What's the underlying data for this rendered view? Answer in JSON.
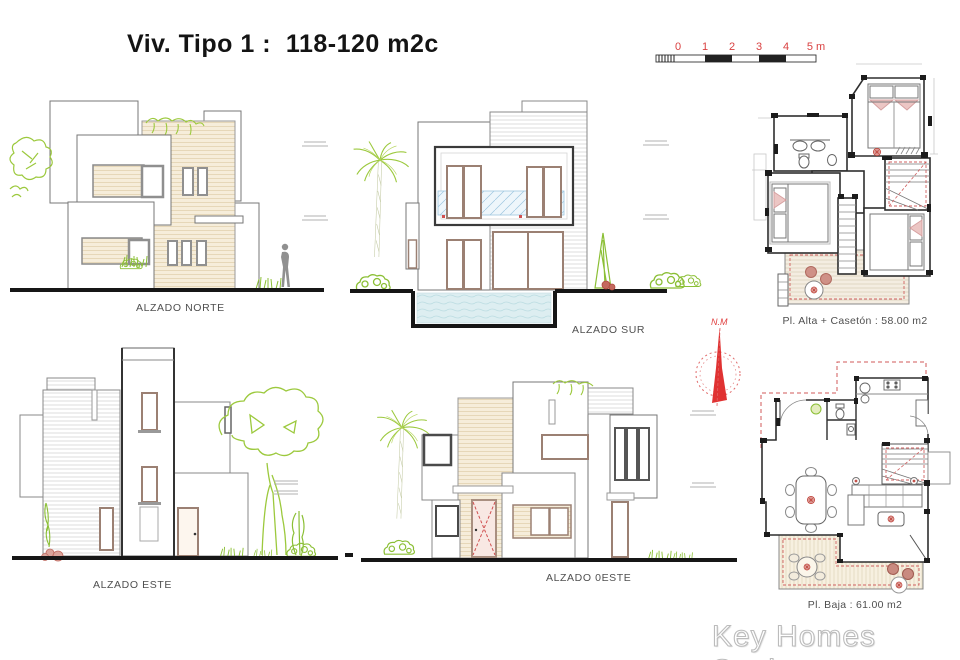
{
  "title": "Viv. Tipo 1 :  118-120 m2c",
  "scale_bar": {
    "ticks": [
      "0",
      "1",
      "2",
      "3",
      "4",
      "5 m"
    ],
    "color": "#d94040"
  },
  "elevations": {
    "norte": {
      "label": "ALZADO NORTE"
    },
    "sur": {
      "label": "ALZADO SUR"
    },
    "este": {
      "label": "ALZADO ESTE"
    },
    "oeste": {
      "label": "ALZADO 0ESTE"
    }
  },
  "plans": {
    "alta": {
      "label": "Pl. Alta + Casetón : 58.00 m2"
    },
    "baja": {
      "label": "Pl. Baja : 61.00 m2"
    }
  },
  "compass": {
    "label": "N.M"
  },
  "watermark": {
    "text": "Key Homes Spain"
  },
  "colors": {
    "accent_red": "#d94040",
    "plant_green": "#9cc93d",
    "facade_beige": "#f6edda",
    "water_blue": "#ddeef1",
    "frame_tan": "#9b8073"
  }
}
